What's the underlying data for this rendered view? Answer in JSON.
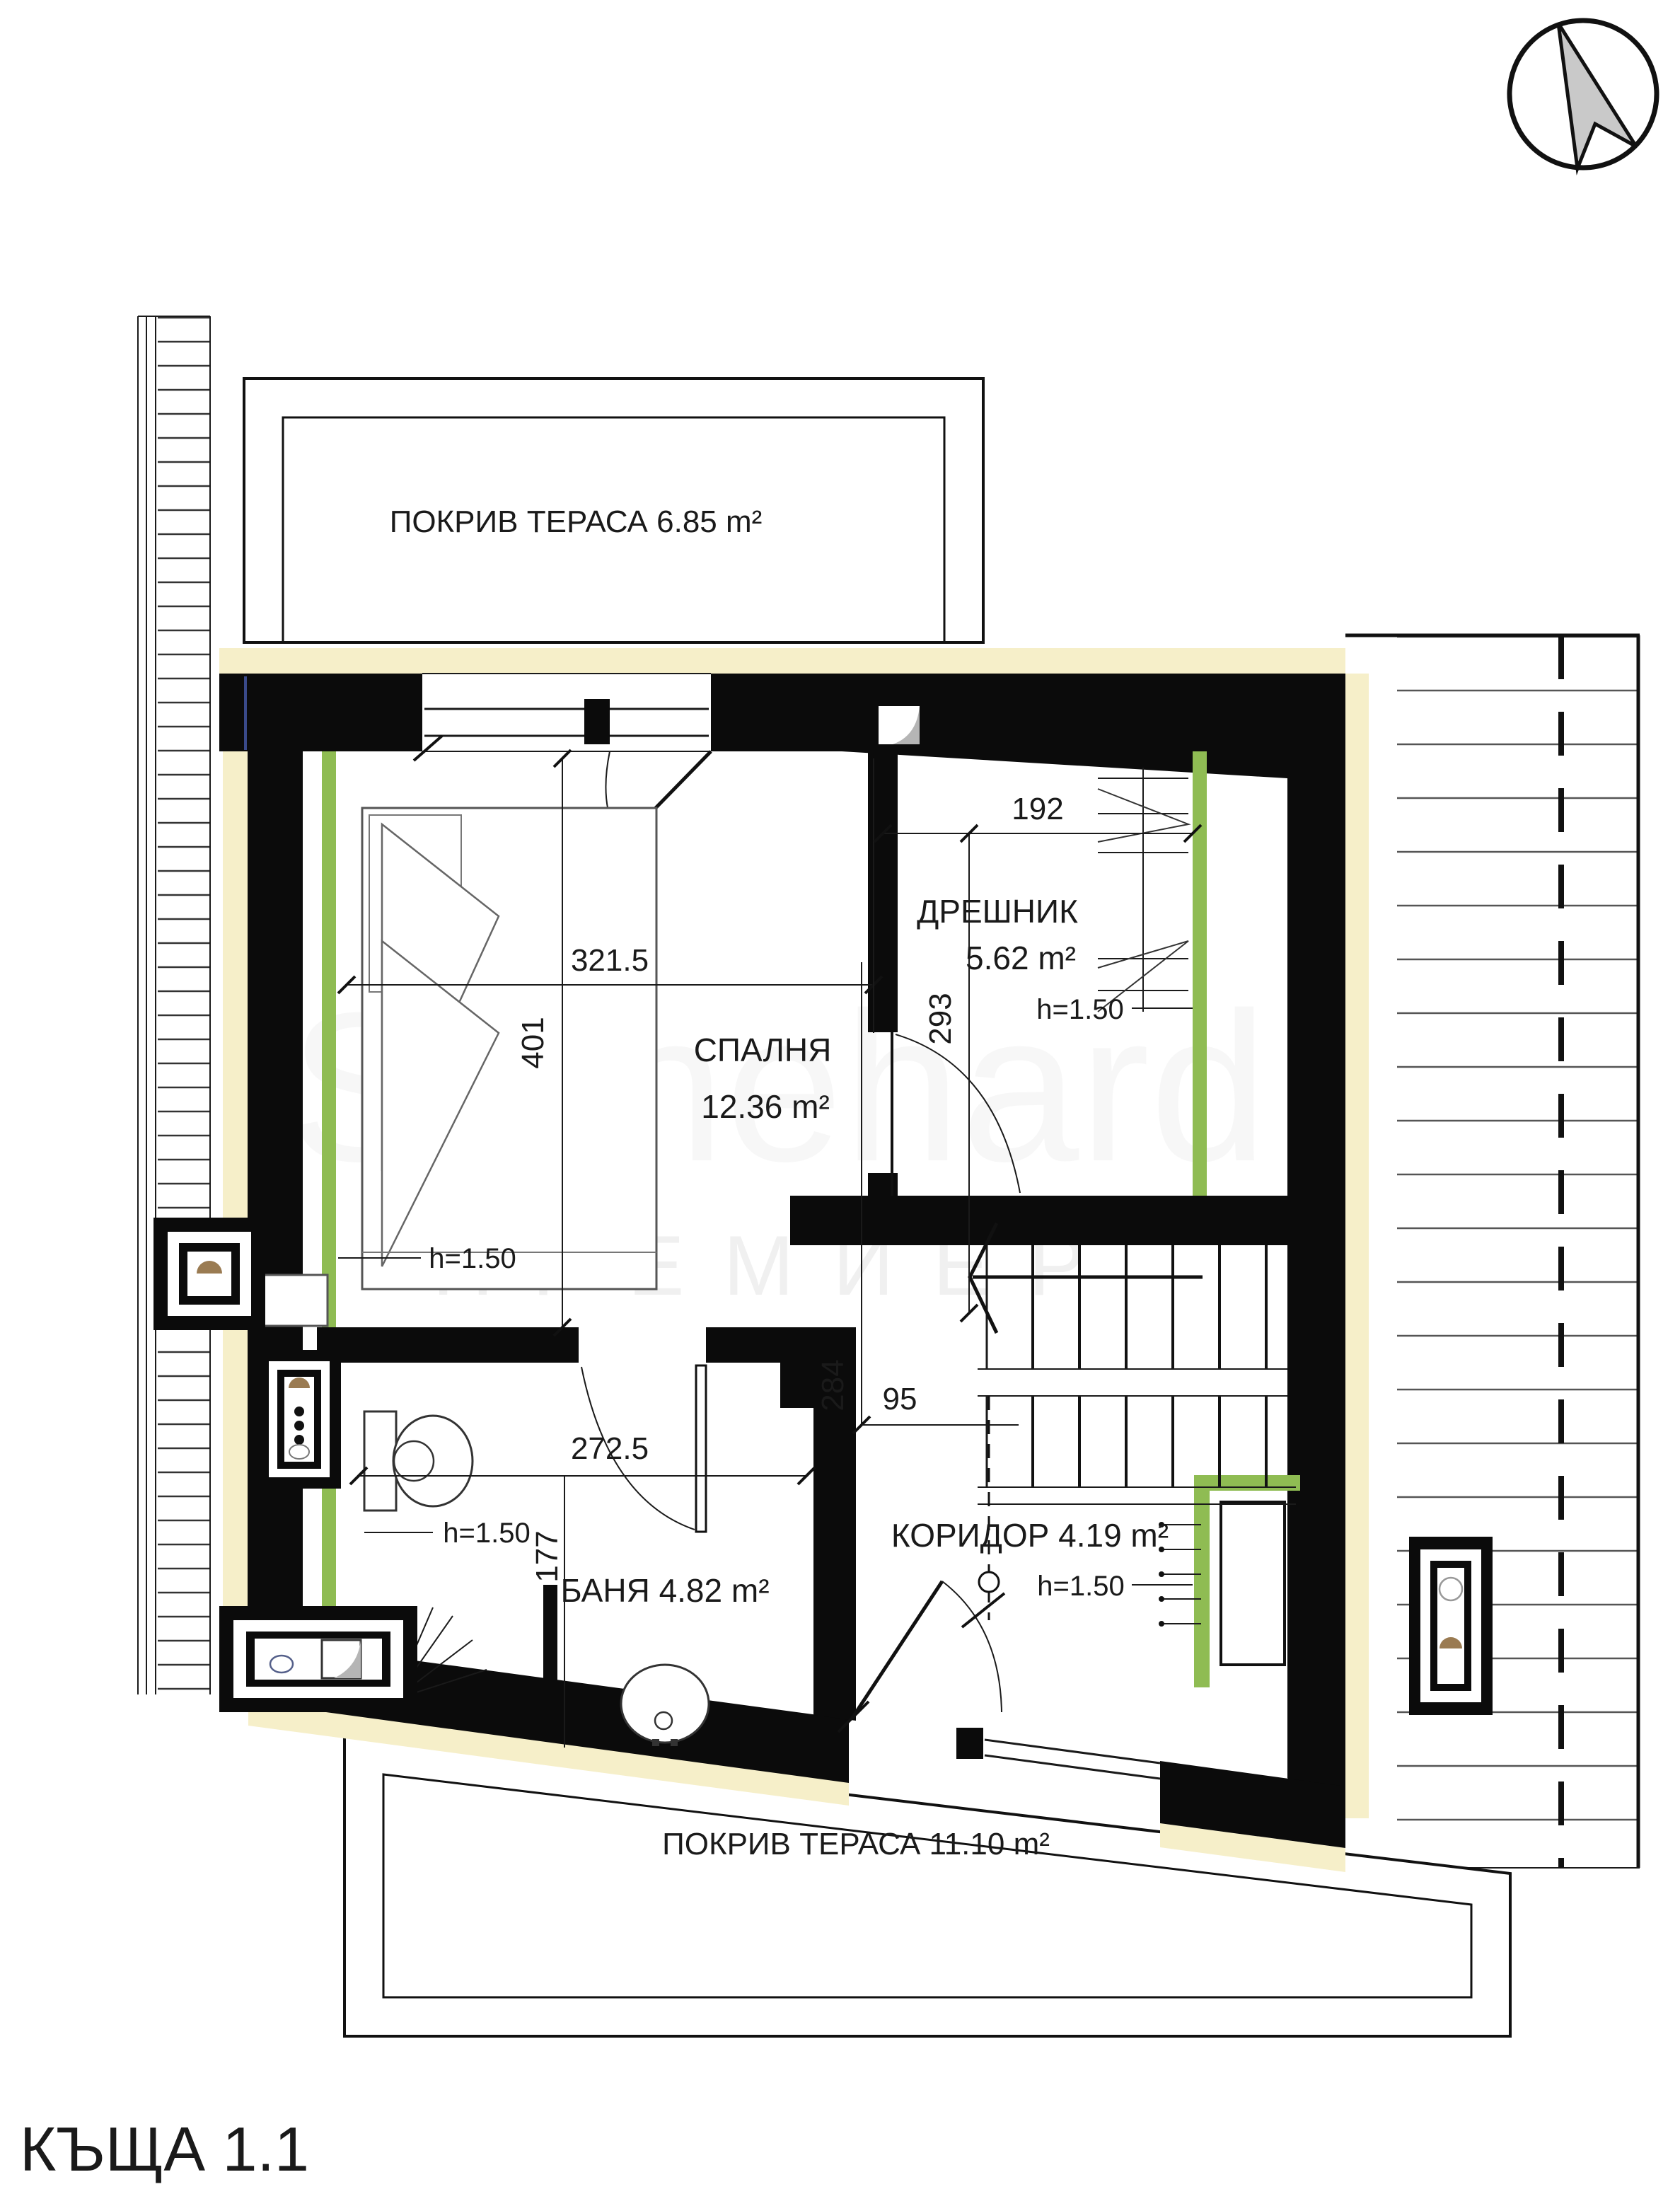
{
  "drawing_title": "КЪЩА 1.1",
  "watermark": {
    "line1": "Stonehard",
    "line2": "ПРЕМИЕР"
  },
  "labels": {
    "terrace_top": "ПОКРИВ ТЕРАСА 6.85 m²",
    "terrace_bottom": "ПОКРИВ ТЕРАСА 11.10 m²",
    "bedroom_name": "СПАЛНЯ",
    "bedroom_area": "12.36 m²",
    "bedroom_height": "h=1.50",
    "dressing_name": "ДРЕШНИК",
    "dressing_area": "5.62 m²",
    "dressing_height": "h=1.50",
    "bathroom": "БАНЯ 4.82 m²",
    "bathroom_height": "h=1.50",
    "corridor": "КОРИДОР 4.19 m²",
    "corridor_height": "h=1.50"
  },
  "dimensions_cm": {
    "bedroom_width": "321.5",
    "bedroom_depth": "401",
    "dressing_width": "192",
    "dressing_depth": "293",
    "bathroom_width": "272.5",
    "bathroom_depth": "177",
    "hall_depth": "284",
    "hall_width": "95"
  },
  "colors": {
    "wall_black": "#0b0b0b",
    "insulation_cream": "#f6efc9",
    "interior_wall_green": "#8fbc53",
    "roof_line": "#555555",
    "north_arrow_fill": "#c9c9c9"
  }
}
